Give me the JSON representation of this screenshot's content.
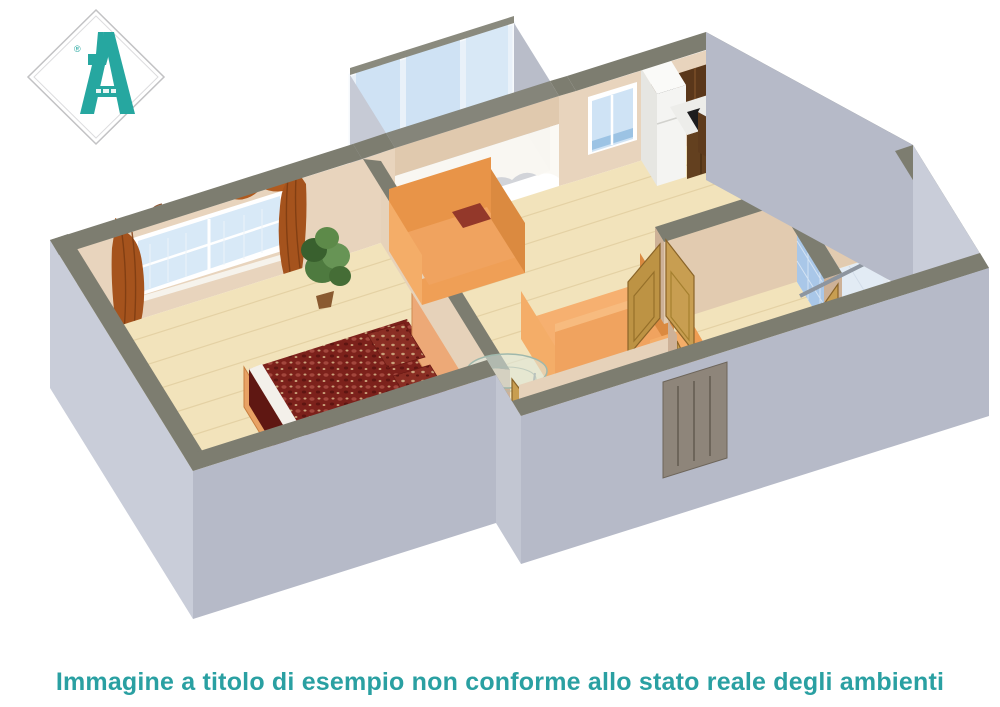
{
  "caption": {
    "text": "Immagine a titolo di esempio non conforme allo stato reale degli ambienti",
    "color": "#2aa0a2"
  },
  "logo": {
    "letter_shape": "stylized-A",
    "registered_mark": "®",
    "color": "#26a7a0"
  },
  "palette": {
    "background": "#ffffff",
    "wall_top_band": "#7d7d70",
    "exterior_wall_light": "#c9cdd9",
    "exterior_wall_shade": "#b6bac8",
    "interior_wall_light": "#e8d4bd",
    "interior_wall_mid": "#e2cbb0",
    "interior_wall_shade": "#cdb197",
    "floor_wood": "#f2e3bb",
    "floor_plank_line": "#e4d1a4",
    "bathroom_tile": "#a9c7e8",
    "bathroom_grout": "#d4e3f3",
    "bathroom_floor": "#e2ebf4",
    "sofa_orange": "#f0a35f",
    "sofa_orange_shade": "#db8a40",
    "cushion_red": "#93382a",
    "bed_quilt": "#7c211b",
    "headboard_peach": "#eda977",
    "curtain_rust": "#a5531d",
    "door_oak": "#c89e51",
    "entry_door": "#8e857a",
    "kitchen_cabinet": "#5a371a",
    "glass_blue": "#cfe2f4",
    "fixture_white": "#f4f7fa",
    "plant_green": "#4e7a3f"
  }
}
